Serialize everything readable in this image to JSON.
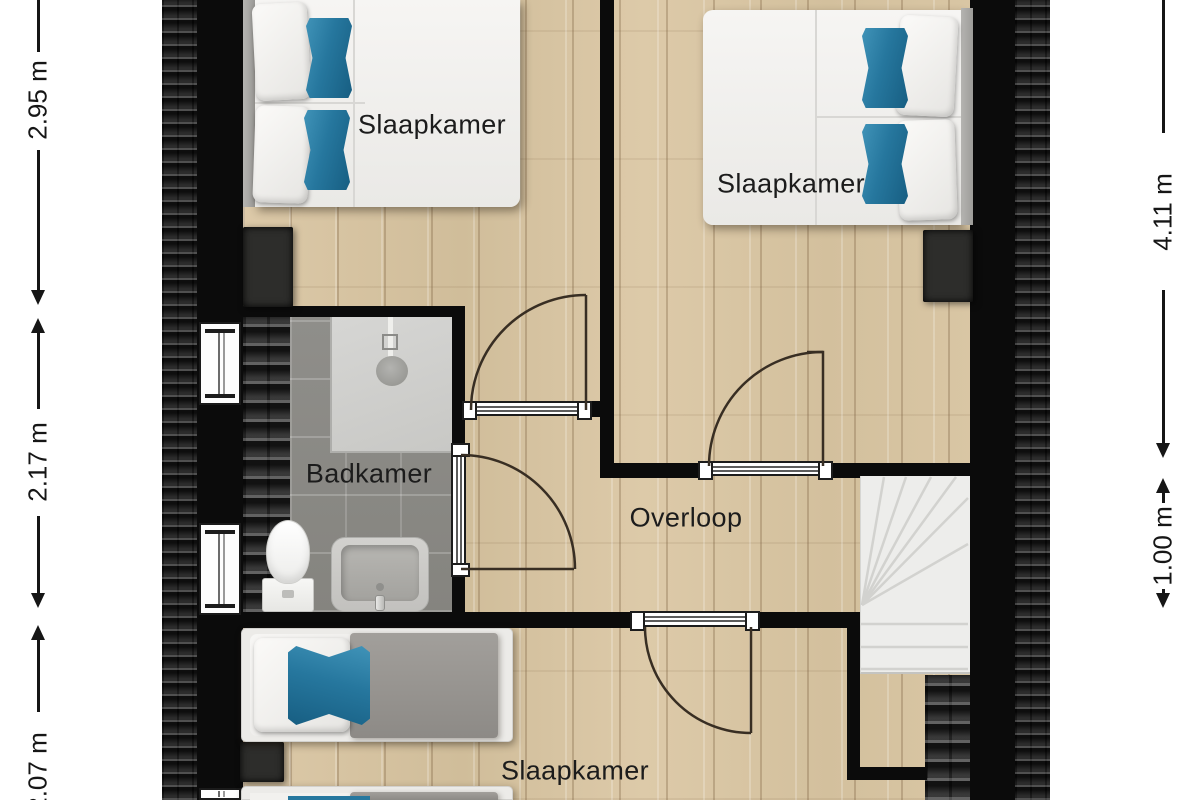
{
  "floorplan": {
    "rooms": {
      "slaapkamer_top_left": {
        "label": "Slaapkamer"
      },
      "slaapkamer_top_right": {
        "label": "Slaapkamer"
      },
      "badkamer": {
        "label": "Badkamer"
      },
      "overloop": {
        "label": "Overloop"
      },
      "slaapkamer_bottom": {
        "label": "Slaapkamer"
      }
    },
    "dimensions": {
      "left": [
        {
          "label": "2.95 m"
        },
        {
          "label": "2.17 m"
        },
        {
          "label": "2.07 m"
        }
      ],
      "right": [
        {
          "label": "4.11 m"
        },
        {
          "label": "1.00 m"
        }
      ]
    },
    "colors": {
      "accent_pillow": "#2b7ca3",
      "wall": "#0b0b0b",
      "wood_floor": "#d7c4a2",
      "bath_tile": "#8b8a86",
      "roof_tiles": "#232323"
    }
  }
}
